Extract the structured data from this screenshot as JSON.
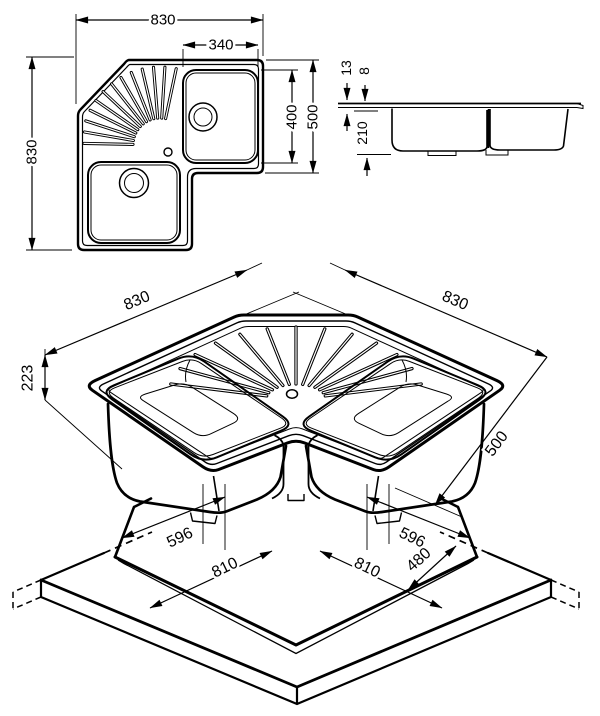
{
  "dims": {
    "plan": {
      "overall_width": "830",
      "bowl_width": "340",
      "overall_depth": "830",
      "bowl_length": "400",
      "arm_depth": "500"
    },
    "side": {
      "rim_height_total": "13",
      "rim_lip": "8",
      "bowl_depth": "210"
    },
    "iso": {
      "edge_left": "830",
      "edge_right": "830",
      "total_height": "223",
      "arm_width": "500"
    },
    "cutout": {
      "left_inner": "596",
      "left_outer": "810",
      "right_inner": "596",
      "right_outer": "810",
      "end_width": "480"
    }
  }
}
